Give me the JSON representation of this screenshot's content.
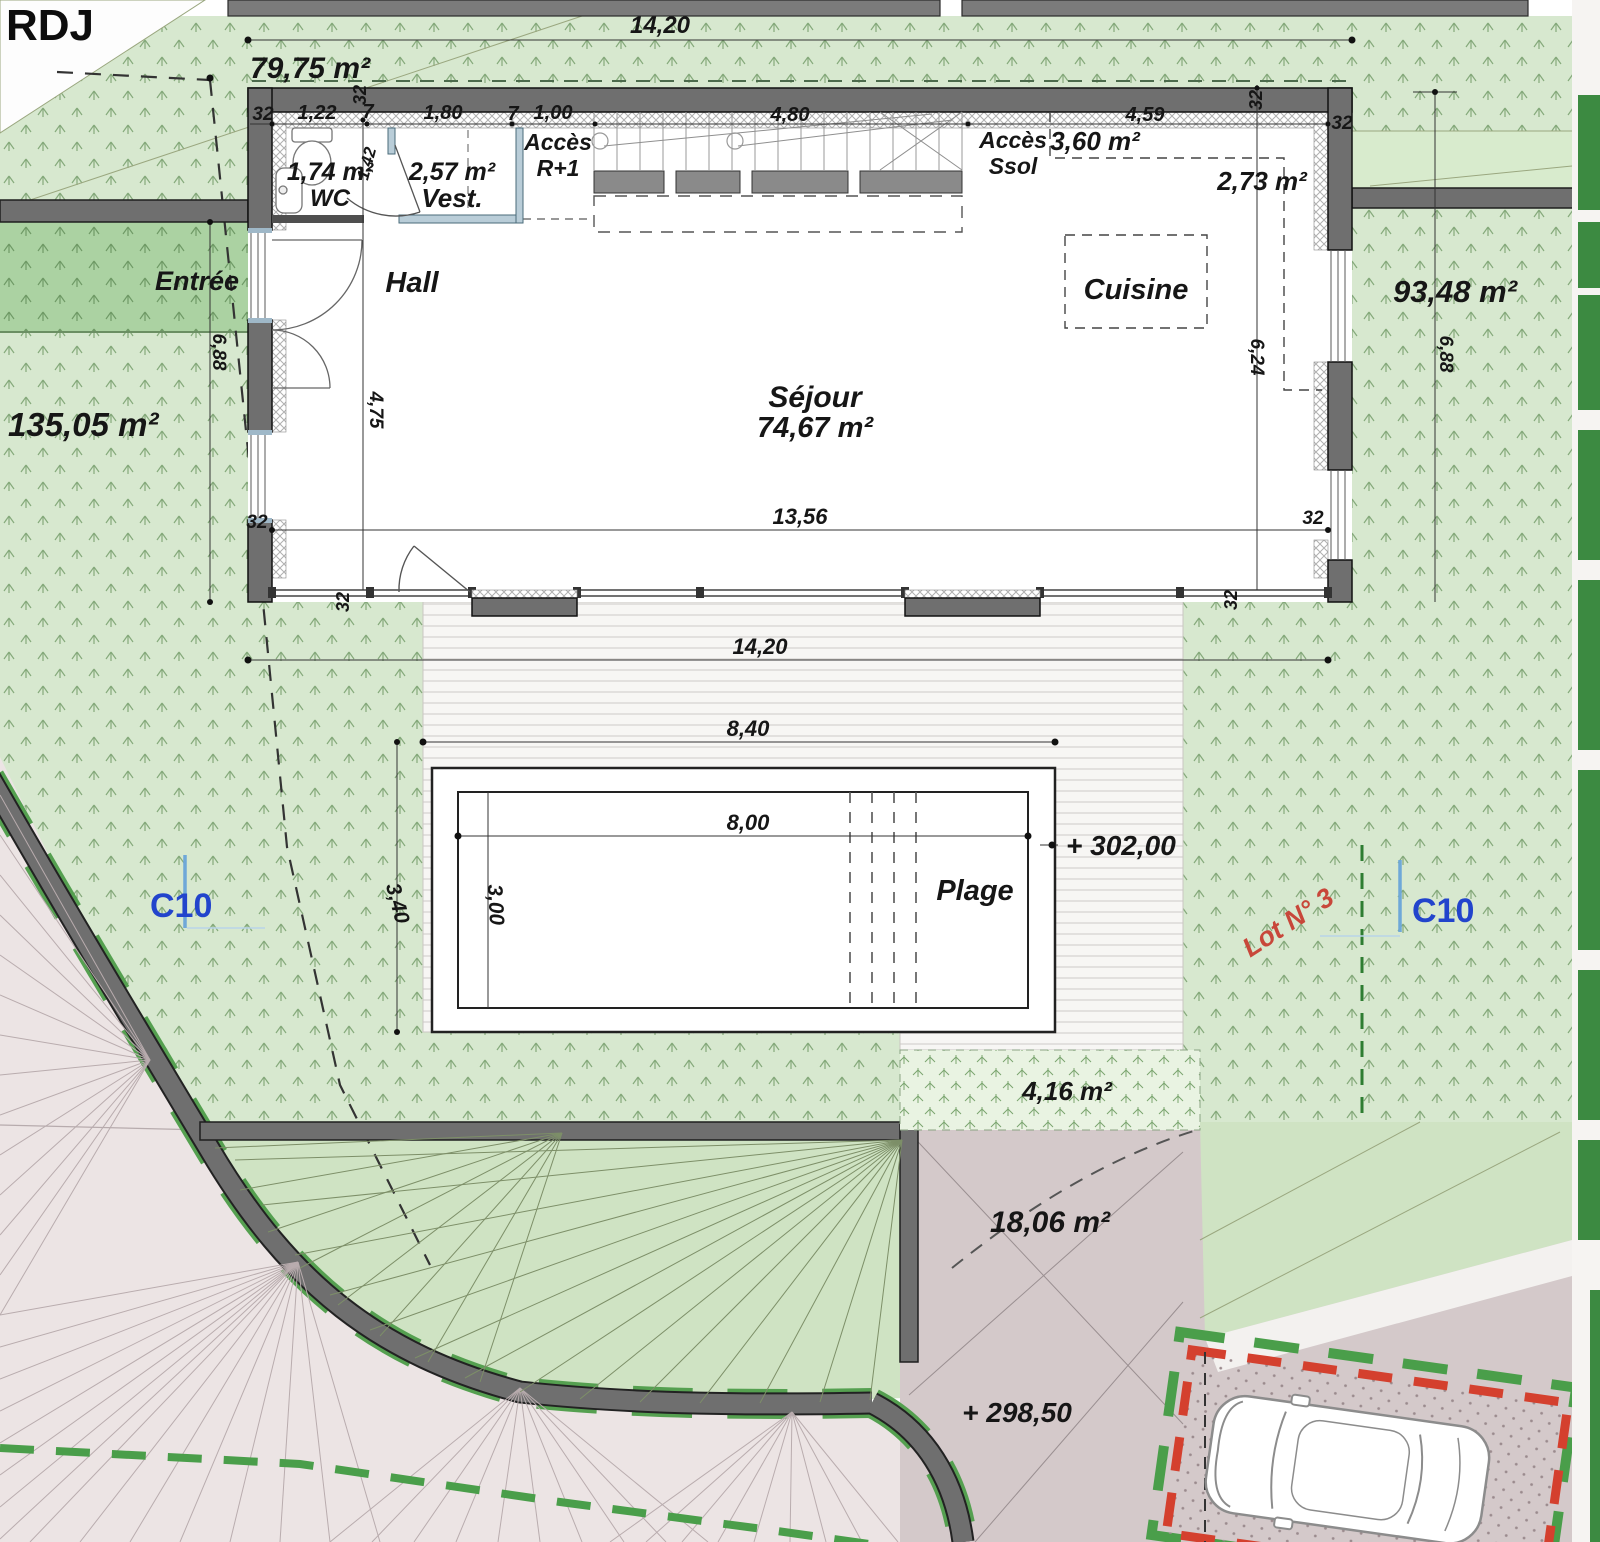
{
  "title": "RDJ",
  "labels": {
    "floor": "RDJ",
    "wc": "WC",
    "vest": "Vest.",
    "hall": "Hall",
    "sejour": "Séjour",
    "cuisine": "Cuisine",
    "entree": "Entrée",
    "plage": "Plage",
    "acces": "Accès",
    "r1": "R+1",
    "ssol": "Ssol"
  },
  "areas": {
    "a7975": "79,75 m²",
    "a9348": "93,48 m²",
    "a13505": "135,05 m²",
    "a7467": "74,67 m²",
    "a174": "1,74 m²",
    "a257": "2,57 m²",
    "a360": "3,60 m²",
    "a273": "2,73 m²",
    "a416": "4,16 m²",
    "a1806": "18,06 m²"
  },
  "dims": {
    "d1420": "14,20",
    "d32": "32",
    "d122": "1,22",
    "d7": "7",
    "d180": "1,80",
    "d100": "1,00",
    "d480": "4,80",
    "d459": "4,59",
    "d142": "1,42",
    "d688": "6,88",
    "d475": "4,75",
    "d624": "6,24",
    "d1356": "13,56",
    "d840": "8,40",
    "d800": "8,00",
    "d340": "3,40",
    "d300": "3,00"
  },
  "levels": {
    "terrace": "+ 302,00",
    "drive": "+ 298,50"
  },
  "markers": {
    "c10": "C10",
    "lot": "Lot N° 3"
  },
  "colors": {
    "lawn": "#d7e8cf",
    "lawn_dark": "#abd2a2",
    "wall_gray": "#6f6f6f",
    "road_pink": "#ece4e4",
    "drive_mauve": "#d4c9ca",
    "accent_red": "#d4402e",
    "boundary_green": "#4a9e4a",
    "marker_blue": "#2244cc",
    "lot_red": "#c8473a"
  }
}
